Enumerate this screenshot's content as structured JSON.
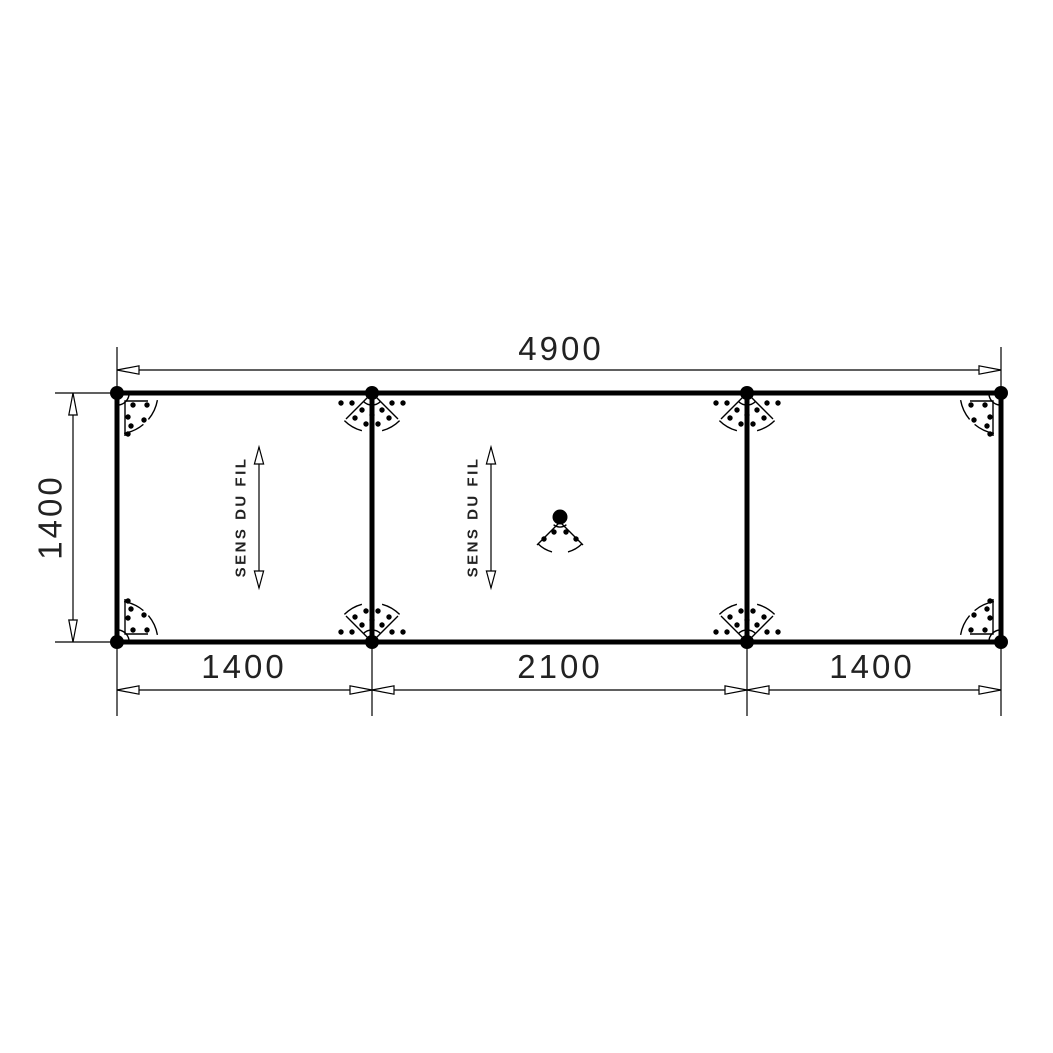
{
  "drawing": {
    "type": "panel-plan-technical-drawing",
    "background_color": "#ffffff",
    "line_color": "#000000",
    "text_color": "#222222",
    "dimensions": {
      "top_total": "4900",
      "left_height": "1400",
      "bottom_segments": [
        "1400",
        "2100",
        "1400"
      ]
    },
    "grain_annotations": [
      {
        "label": "SENS DU FIL"
      },
      {
        "label": "SENS DU FIL"
      }
    ]
  }
}
